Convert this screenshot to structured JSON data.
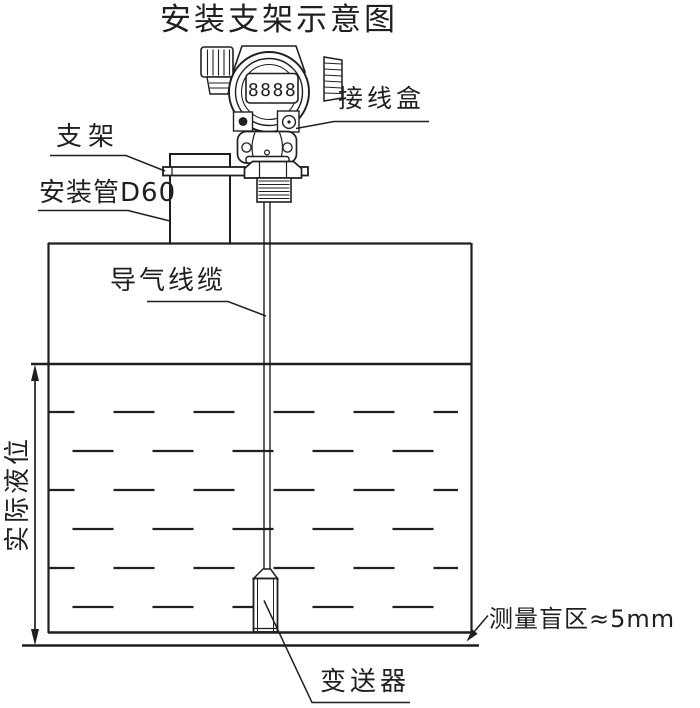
{
  "title": "安装支架示意图",
  "colors": {
    "ink": "#1f1f1f",
    "background": "#ffffff"
  },
  "display": {
    "digits": "8888"
  },
  "labels": {
    "junction_box": "接线盒",
    "bracket": "支架",
    "mounting_pipe": "安装管D60",
    "air_cable": "导气线缆",
    "actual_level": "实际液位",
    "blind_zone": "测量盲区≈5mm",
    "transmitter": "变送器"
  }
}
